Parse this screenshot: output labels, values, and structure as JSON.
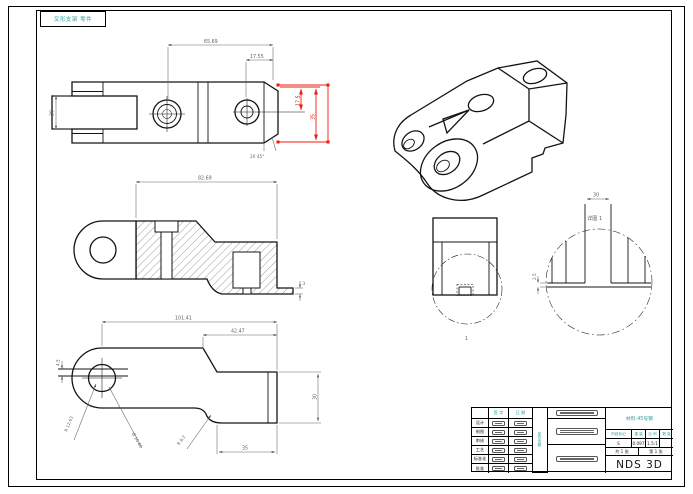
{
  "sheet": {
    "corner_note": "叉形支架 零件"
  },
  "colors": {
    "accent_teal": "#2f9d9d",
    "selection_red": "#ec1c12",
    "line_black": "#141414",
    "dim_gray": "#6b6257"
  },
  "views": {
    "top": {
      "dims": {
        "total": "65.69",
        "right": "17.55",
        "h_small": "17.5",
        "h_big": "35",
        "slot": "30",
        "chamfer": "2X 45°"
      }
    },
    "section": {
      "dims": {
        "width": "82.69",
        "thickness": "3"
      }
    },
    "side": {
      "dims": {
        "length": "101.41",
        "seg": "42.47",
        "height": "30",
        "width": "35",
        "gap": "4.5",
        "radius1": "R 12.63",
        "dia1": "Ø 16.46",
        "radius2": "R 8.2"
      }
    },
    "detail": {
      "dims": {
        "width": "30",
        "thickness": "2.5"
      },
      "callout": "1",
      "title": "详图 1"
    }
  },
  "title_block": {
    "sign_header": "签 字",
    "date_header": "日 期",
    "org": "单位名称",
    "roles": [
      "设计",
      "制图",
      "审核",
      "工艺",
      "标准化",
      "批准"
    ],
    "material_note": "材料:45号钢",
    "field_labels": [
      "阶段标记",
      "重 量",
      "比 例",
      "数 量"
    ],
    "field_values": [
      "S",
      "0.097",
      "1.5:1",
      ""
    ],
    "sheet_total": "共 1 张",
    "sheet_index": "第 1 张",
    "company": "NDS 3D"
  }
}
